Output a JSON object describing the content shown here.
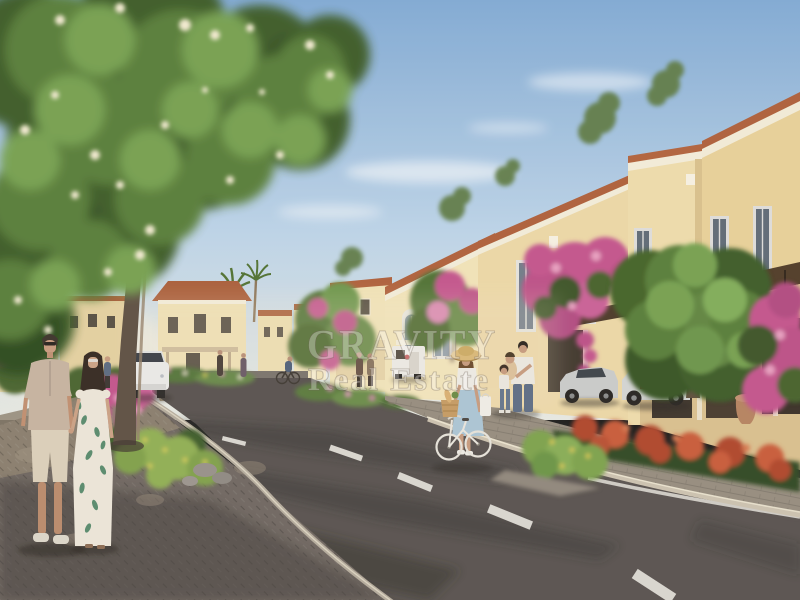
{
  "image": {
    "kind": "real-estate architectural visualization",
    "caption": "Sunlit street in a Mediterranean-style villa community: a couple strolls hand in hand on a brick sidewalk beneath a large flowering tree, a woman in a straw hat wheels a bicycle with a bread basket at the road edge, a family stands by cream townhouses draped in bougainvillea, sports cars sit in the driveways, and a curving asphalt road with dashed white markings leads into the neighborhood.",
    "elements": [
      "flowering shade tree",
      "Mediterranean townhouses",
      "terracotta roof trim",
      "bougainvillea",
      "walking couple",
      "woman with bicycle and straw hat",
      "family with children",
      "parked sports cars",
      "white sedan",
      "white kiosk van",
      "asphalt road with dashed center line",
      "brick sidewalks",
      "stone curbs",
      "flower beds",
      "palm trees",
      "watermark"
    ]
  },
  "watermark": {
    "line1": "GRAVITY",
    "line2": "Real Estate"
  },
  "palette": {
    "sky_top": "#7FA9D4",
    "sky_horizon": "#E6E8E2",
    "cloud": "#FFFFFF",
    "foliage_dark": "#3A5A26",
    "foliage_mid": "#567D38",
    "foliage_light": "#74A050",
    "blossom_white": "#F1EAD0",
    "trunk_brown": "#5C4F42",
    "wall_cream": "#F1E3B8",
    "wall_tan": "#E7D098",
    "trim_white": "#F2EBD7",
    "roof_terracotta": "#AD5E39",
    "window_glass": "#6E7A86",
    "pergola_wood": "#4E3A26",
    "bougainvillea": "#C2538C",
    "flower_pink": "#E79EC0",
    "flower_red": "#AE452C",
    "flower_yellow": "#D2CC58",
    "shrub_green": "#7BA24C",
    "road_asphalt": "#57514E",
    "road_shadow": "#332F2C",
    "marking_white": "#E5E3DD",
    "curb_stone": "#CBC1AF",
    "sidewalk_brick": "#6E6660",
    "paver_light": "#958C7E",
    "car_silver": "#C9CBCA",
    "car_white": "#E9E9E7",
    "skin": "#C69A7E",
    "denim_blue": "#5C6C84",
    "dress_white": "#EBE5D8",
    "dress_blue": "#AAC4D4",
    "straw_hat": "#D8B878",
    "watermark_white": "#FFFFFF"
  }
}
